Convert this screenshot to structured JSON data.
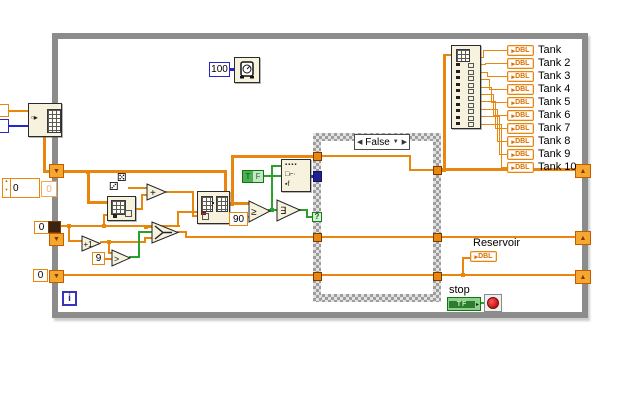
{
  "loop": {
    "iteration_label": "i"
  },
  "timing": {
    "wait_ms": "100"
  },
  "case_structure": {
    "selector": "False",
    "prev_arrow": "◀",
    "next_arrow": "▶",
    "dropdown_arrow": "▼",
    "selector_terminal": "?"
  },
  "constants": {
    "threshold": "90",
    "nine": "9",
    "shift_init_index": "0",
    "shift_init_reservoir": "0",
    "control_value": "0",
    "control_value_dim": "0"
  },
  "booleans": {
    "true_letter": "T",
    "false_letter": "F"
  },
  "node_glyphs": {
    "add": "+",
    "increment": "+1",
    "greater": ">",
    "greater_equal": "≥",
    "or_array": "∃",
    "dice_a": "⚄",
    "dice_b": "⚂",
    "init_array": "▫▸",
    "select_row1": "▪▪▪▪",
    "select_row2": "□⌐·",
    "select_row3": "▪f",
    "shift_down": "▼",
    "shift_up": "▲"
  },
  "indicators": {
    "dbl_arrow": "▸",
    "dbl_text": "DBL",
    "tanks": [
      "Tank",
      "Tank 2",
      "Tank 3",
      "Tank 4",
      "Tank 5",
      "Tank 6",
      "Tank 7",
      "Tank 8",
      "Tank 9",
      "Tank 10"
    ],
    "reservoir_label": "Reservoir"
  },
  "stop": {
    "label": "stop",
    "bool_text": "TF"
  },
  "colors": {
    "wire_orange": "#E8860D",
    "wire_green": "#2BA12B",
    "wire_blue": "#2626C9",
    "node_bg": "#F6F2DE",
    "loop_border": "#8C8C8C",
    "boolean_green": "#0B7A0B",
    "stop_red": "#C41212"
  }
}
